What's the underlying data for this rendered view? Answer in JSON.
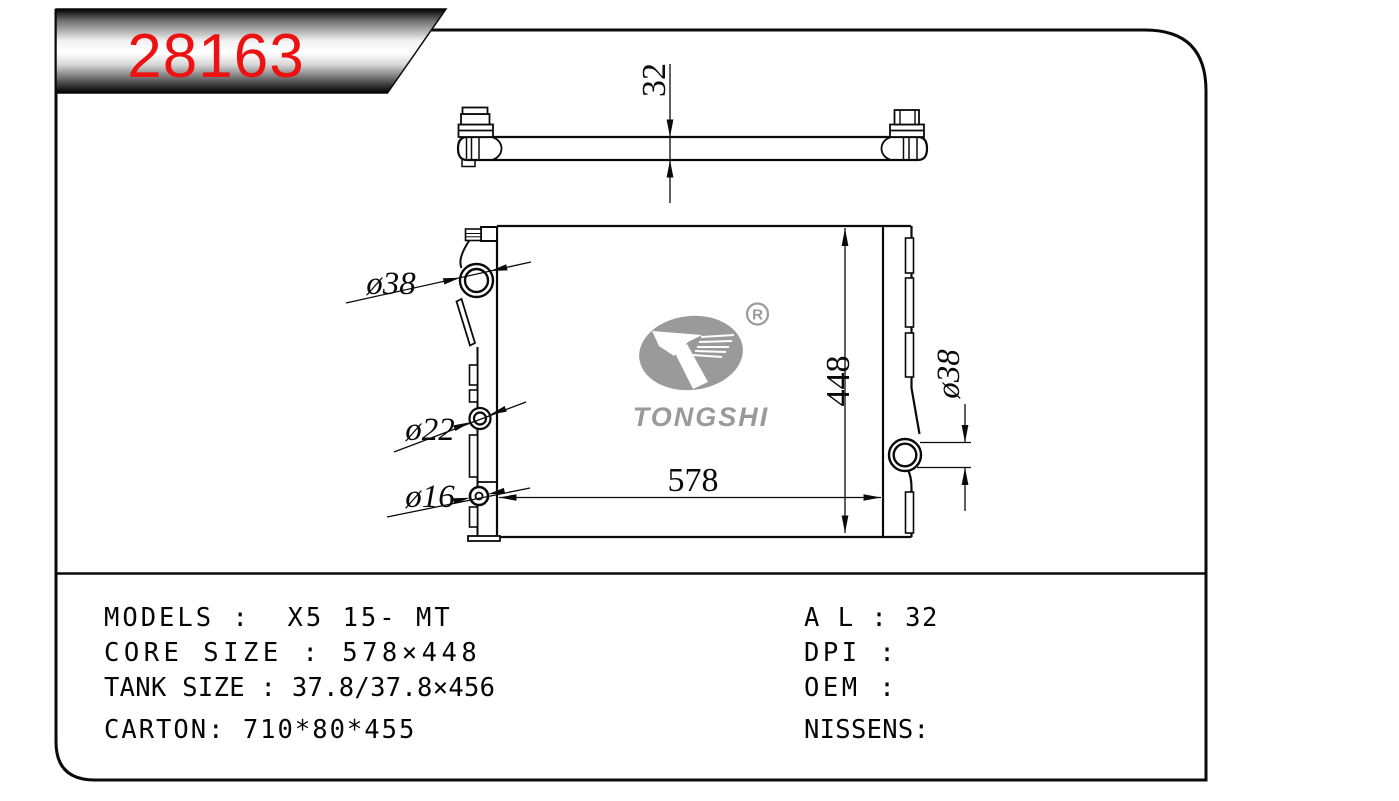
{
  "badge": {
    "part_number": "28163"
  },
  "side_view": {
    "thickness_label": "32"
  },
  "front_view": {
    "width_label": "578",
    "height_label": "448",
    "port_top_left_label": "ø38",
    "port_mid_left_label": "ø22",
    "port_bottom_left_label": "ø16",
    "port_right_label": "ø38"
  },
  "logo": {
    "brand": "TONGSHI",
    "registered": "R"
  },
  "specs": {
    "left": [
      "MODELS :  X5 15- MT",
      "CORE SIZE : 578×448",
      "TANK SIZE : 37.8/37.8×456",
      "CARTON: 710*80*455"
    ],
    "right": [
      "A L : 32",
      "DPI :",
      "OEM :",
      "NISSENS:"
    ]
  },
  "colors": {
    "part_number_red": "#ee1111",
    "logo_gray": "#9a9a9a"
  }
}
